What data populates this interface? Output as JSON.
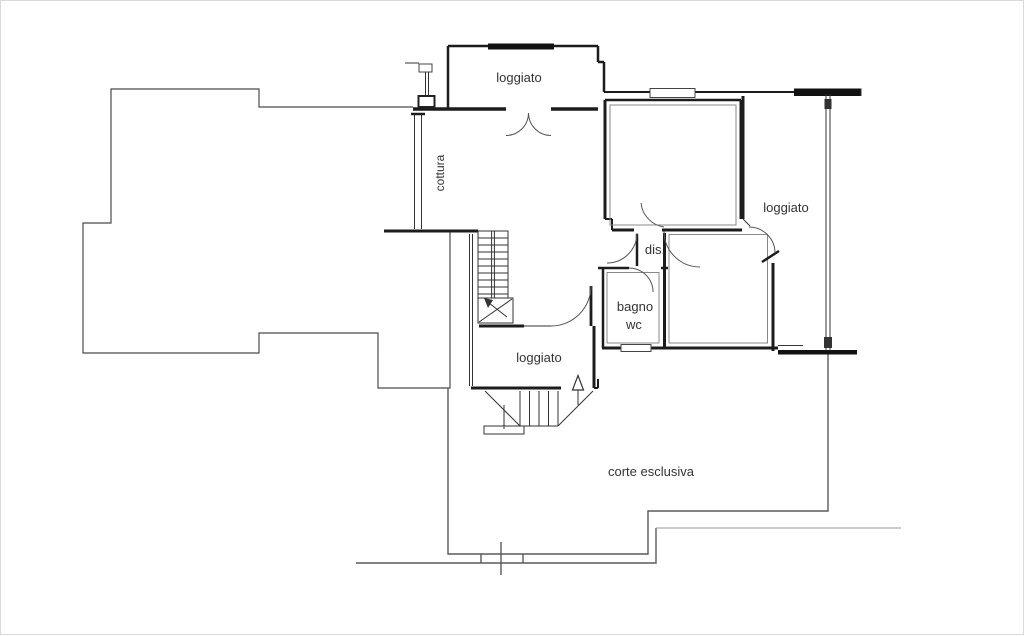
{
  "plan": {
    "labels": {
      "loggiato_top": "loggiato",
      "cottura": "cottura",
      "loggiato_right": "loggiato",
      "dis": "dis.",
      "bagno": "bagno",
      "wc": "wc",
      "loggiato_bottom": "loggiato",
      "corte_esclusiva": "corte esclusiva"
    },
    "colors": {
      "wall": "#1c1c1c",
      "outline": "#4a4a4a",
      "boundary": "#5a5a5a",
      "site": "#9a9a9a",
      "text": "#333333",
      "background": "#ffffff"
    }
  }
}
